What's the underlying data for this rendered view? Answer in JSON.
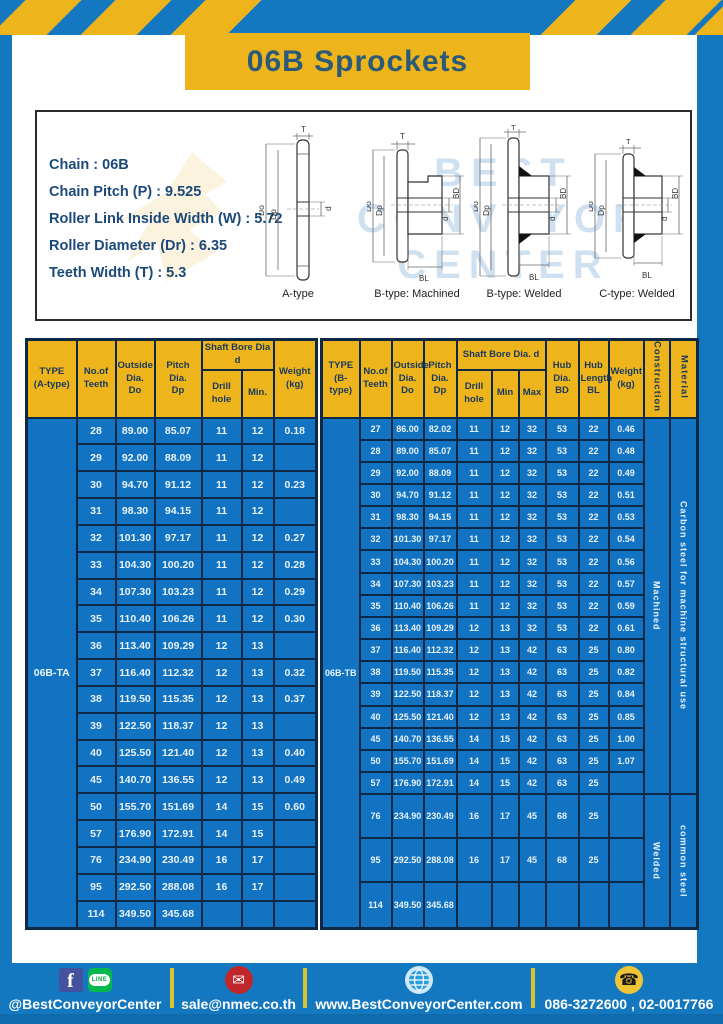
{
  "title": "06B Sprockets",
  "specs": [
    "Chain : 06B",
    "Chain Pitch (P) : 9.525",
    "Roller Link Inside Width (W) : 5.72",
    "Roller Diameter (Dr) : 6.35",
    "Teeth Width (T) : 5.3"
  ],
  "diagrams": {
    "labels": [
      "A-type",
      "B-type: Machined",
      "B-type: Welded",
      "C-type: Welded"
    ],
    "dims": {
      "t": "T",
      "do": "Do",
      "dp": "Dp",
      "d": "d",
      "bd": "BD",
      "bl": "BL"
    },
    "watermark": [
      "BEST",
      "CONVEYOR",
      "CENTER"
    ]
  },
  "table_a": {
    "header": {
      "type": "TYPE\n(A-type)",
      "teeth": "No.of\nTeeth",
      "outside": "Outside\nDia.\nDo",
      "pitch": "Pitch Dia.\nDp",
      "shaft_bore": "Shaft Bore Dia d",
      "drill": "Drill hole",
      "min": "Min.",
      "weight": "Weight\n(kg)"
    },
    "type_value": "06B-TA",
    "rows": [
      [
        "28",
        "89.00",
        "85.07",
        "11",
        "12",
        "0.18"
      ],
      [
        "29",
        "92.00",
        "88.09",
        "11",
        "12",
        ""
      ],
      [
        "30",
        "94.70",
        "91.12",
        "11",
        "12",
        "0.23"
      ],
      [
        "31",
        "98.30",
        "94.15",
        "11",
        "12",
        ""
      ],
      [
        "32",
        "101.30",
        "97.17",
        "11",
        "12",
        "0.27"
      ],
      [
        "33",
        "104.30",
        "100.20",
        "11",
        "12",
        "0.28"
      ],
      [
        "34",
        "107.30",
        "103.23",
        "11",
        "12",
        "0.29"
      ],
      [
        "35",
        "110.40",
        "106.26",
        "11",
        "12",
        "0.30"
      ],
      [
        "36",
        "113.40",
        "109.29",
        "12",
        "13",
        ""
      ],
      [
        "37",
        "116.40",
        "112.32",
        "12",
        "13",
        "0.32"
      ],
      [
        "38",
        "119.50",
        "115.35",
        "12",
        "13",
        "0.37"
      ],
      [
        "39",
        "122.50",
        "118.37",
        "12",
        "13",
        ""
      ],
      [
        "40",
        "125.50",
        "121.40",
        "12",
        "13",
        "0.40"
      ],
      [
        "45",
        "140.70",
        "136.55",
        "12",
        "13",
        "0.49"
      ],
      [
        "50",
        "155.70",
        "151.69",
        "14",
        "15",
        "0.60"
      ],
      [
        "57",
        "176.90",
        "172.91",
        "14",
        "15",
        ""
      ],
      [
        "76",
        "234.90",
        "230.49",
        "16",
        "17",
        ""
      ],
      [
        "95",
        "292.50",
        "288.08",
        "16",
        "17",
        ""
      ],
      [
        "114",
        "349.50",
        "345.68",
        "",
        "",
        ""
      ]
    ]
  },
  "table_b": {
    "header": {
      "type": "TYPE\n(B-type)",
      "teeth": "No.of\nTeeth",
      "outside": "Outside\nDia.\nDo",
      "pitch": "Pitch\nDia.\nDp",
      "shaft_bore": "Shaft Bore Dia. d",
      "drill": "Drill hole",
      "min": "Min",
      "max": "Max",
      "hub_dia": "Hub\nDia.\nBD",
      "hub_len": "Hub\nLength\nBL",
      "weight": "Weight\n(kg)",
      "construction": "Construction",
      "material": "Material"
    },
    "type_value": "06B-TB",
    "rows": [
      [
        "27",
        "86.00",
        "82.02",
        "11",
        "12",
        "32",
        "53",
        "22",
        "0.46"
      ],
      [
        "28",
        "89.00",
        "85.07",
        "11",
        "12",
        "32",
        "53",
        "22",
        "0.48"
      ],
      [
        "29",
        "92.00",
        "88.09",
        "11",
        "12",
        "32",
        "53",
        "22",
        "0.49"
      ],
      [
        "30",
        "94.70",
        "91.12",
        "11",
        "12",
        "32",
        "53",
        "22",
        "0.51"
      ],
      [
        "31",
        "98.30",
        "94.15",
        "11",
        "12",
        "32",
        "53",
        "22",
        "0.53"
      ],
      [
        "32",
        "101.30",
        "97.17",
        "11",
        "12",
        "32",
        "53",
        "22",
        "0.54"
      ],
      [
        "33",
        "104.30",
        "100.20",
        "11",
        "12",
        "32",
        "53",
        "22",
        "0.56"
      ],
      [
        "34",
        "107.30",
        "103.23",
        "11",
        "12",
        "32",
        "53",
        "22",
        "0.57"
      ],
      [
        "35",
        "110.40",
        "106.26",
        "11",
        "12",
        "32",
        "53",
        "22",
        "0.59"
      ],
      [
        "36",
        "113.40",
        "109.29",
        "12",
        "13",
        "32",
        "53",
        "22",
        "0.61"
      ],
      [
        "37",
        "116.40",
        "112.32",
        "12",
        "13",
        "42",
        "63",
        "25",
        "0.80"
      ],
      [
        "38",
        "119.50",
        "115.35",
        "12",
        "13",
        "42",
        "63",
        "25",
        "0.82"
      ],
      [
        "39",
        "122.50",
        "118.37",
        "12",
        "13",
        "42",
        "63",
        "25",
        "0.84"
      ],
      [
        "40",
        "125.50",
        "121.40",
        "12",
        "13",
        "42",
        "63",
        "25",
        "0.85"
      ],
      [
        "45",
        "140.70",
        "136.55",
        "14",
        "15",
        "42",
        "63",
        "25",
        "1.00"
      ],
      [
        "50",
        "155.70",
        "151.69",
        "14",
        "15",
        "42",
        "63",
        "25",
        "1.07"
      ],
      [
        "57",
        "176.90",
        "172.91",
        "14",
        "15",
        "42",
        "63",
        "25",
        ""
      ],
      [
        "76",
        "234.90",
        "230.49",
        "16",
        "17",
        "45",
        "68",
        "25",
        ""
      ],
      [
        "95",
        "292.50",
        "288.08",
        "16",
        "17",
        "45",
        "68",
        "25",
        ""
      ],
      [
        "114",
        "349.50",
        "345.68",
        "",
        "",
        "",
        "",
        "",
        ""
      ]
    ],
    "spans": [
      {
        "start": 0,
        "rows": 17,
        "construction": "Machined",
        "material": "Carbon steel for machine structural use"
      },
      {
        "start": 17,
        "rows": 3,
        "construction": "Welded",
        "material": "common steel"
      }
    ]
  },
  "footer": {
    "social_handle": "@BestConveyorCenter",
    "email": "sale@nmec.co.th",
    "website": "www.BestConveyorCenter.com",
    "phones": "086-3272600 , 02-0017766",
    "icons": {
      "facebook": "f",
      "line": "LINE",
      "mail": "✉",
      "globe": "globe",
      "phone": "☎"
    }
  },
  "colors": {
    "frame_blue": "#1478c0",
    "accent_yellow": "#eeb41c",
    "cell_blue": "#1173c2",
    "border_navy": "#0d2844",
    "title_text": "#2a5a78",
    "footer_strip": "#0f6bab"
  }
}
